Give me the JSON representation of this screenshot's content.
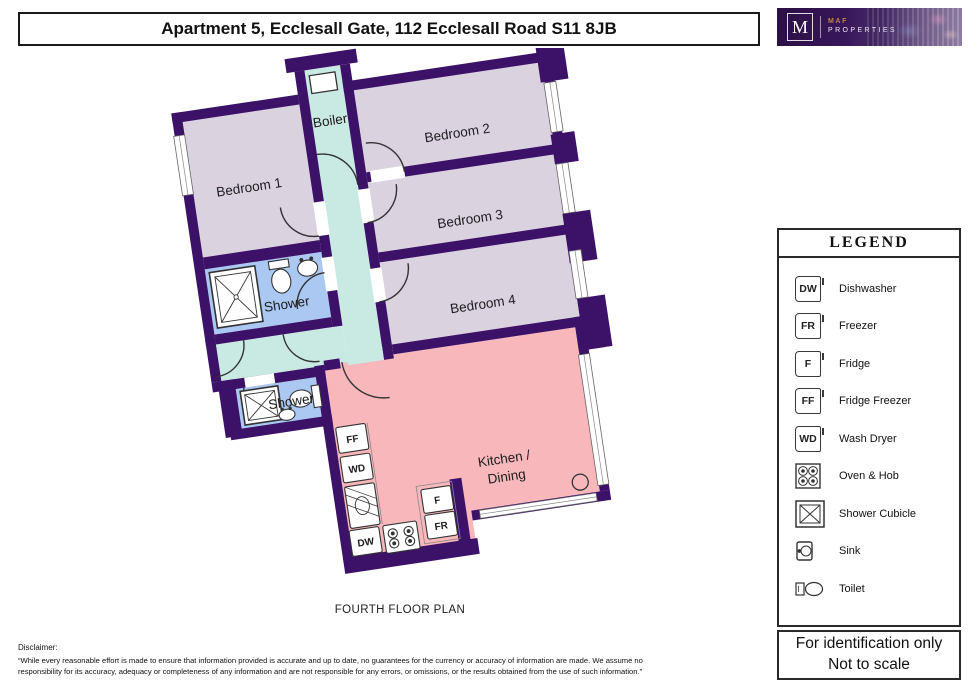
{
  "header": {
    "title": "Apartment 5, Ecclesall Gate, 112 Ecclesall Road S11 8JB"
  },
  "logo": {
    "initial": "M",
    "brand_line1": "MAF",
    "brand_line2": "PROPERTIES"
  },
  "floor_plan": {
    "caption": "FOURTH FLOOR PLAN",
    "rooms": {
      "bedroom1": "Bedroom 1",
      "bedroom2": "Bedroom 2",
      "bedroom3": "Bedroom 3",
      "bedroom4": "Bedroom 4",
      "boiler": "Boiler",
      "shower1": "Shower",
      "shower2": "Shower",
      "kitchen_line1": "Kitchen /",
      "kitchen_line2": "Dining"
    },
    "appliance_labels": {
      "ff": "FF",
      "wd": "WD",
      "dw": "DW",
      "f": "F",
      "fr": "FR"
    }
  },
  "legend": {
    "title": "LEGEND",
    "items": [
      {
        "code": "DW",
        "label": "Dishwasher"
      },
      {
        "code": "FR",
        "label": "Freezer"
      },
      {
        "code": "F",
        "label": "Fridge"
      },
      {
        "code": "FF",
        "label": "Fridge Freezer"
      },
      {
        "code": "WD",
        "label": "Wash Dryer"
      },
      {
        "label": "Oven & Hob"
      },
      {
        "label": "Shower Cubicle"
      },
      {
        "label": "Sink"
      },
      {
        "label": "Toilet"
      }
    ]
  },
  "note": {
    "line1": "For identification only",
    "line2": "Not to scale"
  },
  "disclaimer": {
    "heading": "Disclaimer:",
    "line1": "“While every reasonable effort is made to ensure that information provided is accurate and up to date, no guarantees for the currency or accuracy of information are made. We assume no",
    "line2": "responsibility for its accuracy, adequacy or completeness of any information and are not responsible for any errors, or omissions, or the results obtained from the use of such information.”"
  },
  "colors": {
    "wall": "#3c1168",
    "bedroom_fill": "#dbd2e0",
    "hallway_fill": "#c9eae2",
    "shower_fill": "#aac8f1",
    "kitchen_fill": "#f8b7bb",
    "logo_purple": "#38175a",
    "logo_accent": "#c08449"
  }
}
